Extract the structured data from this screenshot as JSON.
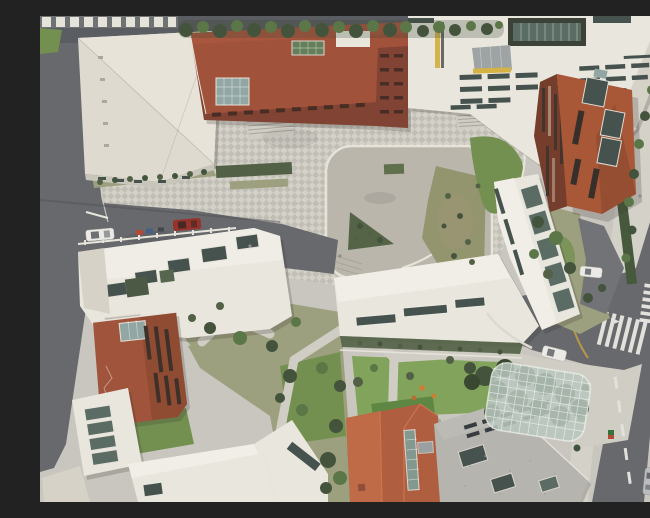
{
  "meta": {
    "subject": "Top-down aerial drone photograph of a school campus: white flat-roofed volumes and terracotta pitched roofs around a central checker-paved plaza with a rounded concrete courtyard, gardens, a glass canopy over a playground, and perimeter asphalt roads with crosswalks and cars"
  },
  "palette": {
    "asphalt": "#606266",
    "asphalt_dark": "#53565a",
    "asphalt_light": "#6b6d70",
    "paving": "#c8c5bd",
    "paving_light": "#d3d0c8",
    "paving_dark": "#bfbcb3",
    "concrete": "#b9b4a9",
    "concrete_light": "#cfccc2",
    "white": "#e9e6de",
    "white_bright": "#f2efe7",
    "white_shade": "#d5d1c7",
    "wall": "#c7c3b9",
    "gym": "#dedacf",
    "gym_light": "#e7e3d9",
    "terracotta": "#9d4a32",
    "terracotta_light": "#ab5438",
    "terracotta_facade": "#7c3a2a",
    "diag_terracotta": "#a5502e",
    "diag_terracotta_dark": "#8c4326",
    "diag_facade": "#6e3422",
    "west_terracotta": "#9c4c33",
    "west_terracotta_dark": "#8a4229",
    "orange_roof": "#ad5737",
    "orange_roof_light": "#bd6540",
    "orange_ridge": "#c96f48",
    "gray_roof": "#b3b1ab",
    "glass_dark": "#3e4a46",
    "glass_teal": "#54665e",
    "glass_green": "#5d7a52",
    "glass_pale": "#8ea4a0",
    "lawn": "#6d8c48",
    "lawn_bright": "#7da054",
    "turf": "#57823c",
    "garden": "#999c79",
    "shrub": "#4a5a3d",
    "tree": "#3b4c33",
    "tree_light": "#55713f",
    "hedge": "#3f5234",
    "canopy": "#b7c6bd",
    "yellow_accent": "#d4af3c",
    "road_yellow": "#c19a38",
    "road_line": "#e3e1dc",
    "curb": "#e6e3da",
    "car_white": "#eceae6",
    "car_red": "#932a22",
    "car_silver": "#b8babc",
    "car_glass": "#3a3f44"
  },
  "scene": {
    "ground": [
      "checker-paved plaza",
      "rounded concrete courtyard",
      "entrance apron",
      "two stair flights"
    ],
    "roads": [
      "top street with tree row",
      "left access road",
      "middle parking road",
      "right street with junction"
    ],
    "markings": [
      "two zebra crossings",
      "white lane dashes",
      "yellow center line",
      "diamond symbols"
    ],
    "buildings": [
      "gym hall",
      "main terracotta block with green skylight and glass atrium",
      "north white block with recessed glass courtyard and slit windows",
      "rotated terracotta block with roof windows",
      "east white slab with skylight row",
      "center wing with ribbon windows",
      "west wing with skylights",
      "west terracotta house",
      "southwest white houses",
      "south orange hip roof",
      "south gray roof with louvers"
    ],
    "landscape": [
      "street trees",
      "garden lawns and paths",
      "shrub planters",
      "hedge strip",
      "glass canopy over playground"
    ],
    "vehicles": [
      "parked white car",
      "parked red car",
      "white car at junction",
      "white car on drive",
      "silver car on south road",
      "red car on south road"
    ]
  }
}
